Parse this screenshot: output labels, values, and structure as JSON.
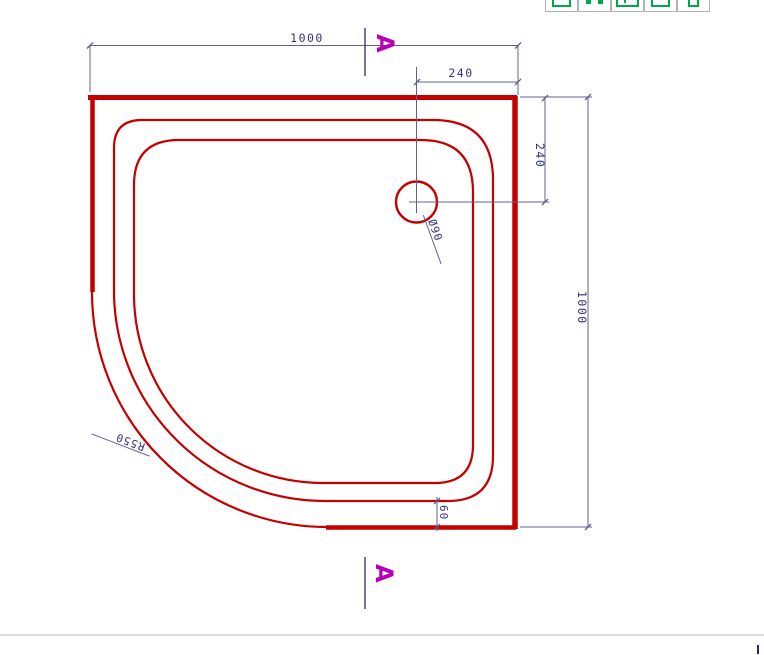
{
  "toolbar": {
    "buttons": [
      {
        "icon": "frame-icon"
      },
      {
        "icon": "nodes-icon"
      },
      {
        "icon": "table-icon"
      },
      {
        "icon": "box-icon"
      },
      {
        "icon": "tag-icon"
      }
    ]
  },
  "drawing": {
    "type": "quadrant-shower-tray-plan",
    "labels": {
      "width_top": "1000",
      "height_right": "1000",
      "drain_offset_horizontal": "240",
      "drain_offset_vertical": "240",
      "rim_gap": "60",
      "drain_diameter": "Ø90",
      "corner_radius": "R550",
      "section_top": "A",
      "section_bottom": "A"
    },
    "colors": {
      "outline": "#c40000",
      "dimension_line": "#60608c",
      "dimension_text": "#32327c",
      "section_marker": "#b800b8"
    }
  }
}
